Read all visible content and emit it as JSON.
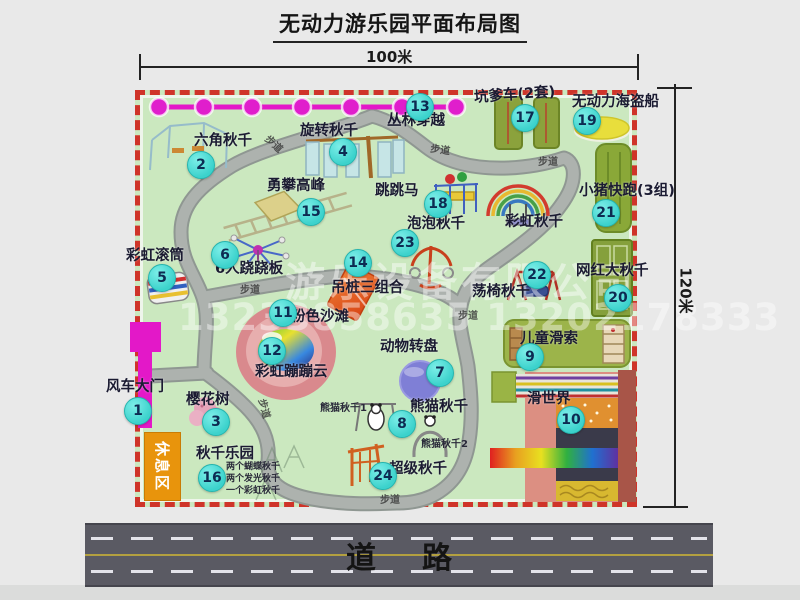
{
  "title": "无动力游乐园平面布局图",
  "dimensions": {
    "width_label": "100米",
    "height_label": "120米"
  },
  "road": {
    "label": "道路"
  },
  "rest_area": {
    "label": "休息区"
  },
  "watermark": {
    "company": "游乐设备有限公司",
    "phone": "13233858635 13202178333"
  },
  "colors": {
    "park_green": "#cbe8bf",
    "border_red": "#cf3429",
    "path_gray": "#a9afab",
    "marker_fill": "#3cd2cc",
    "marker_text": "#0d2b52",
    "zipline_magenta": "#e318c8",
    "road_gray": "#5a5a63",
    "rest_orange": "#e8940c",
    "pink_beach": "#d9898d"
  },
  "attractions": [
    {
      "num": 1,
      "key": "windmill-gate",
      "name": "风车大门",
      "mx": 137,
      "my": 410,
      "lx": 106,
      "ly": 380
    },
    {
      "num": 2,
      "key": "hexagon-swing",
      "name": "六角秋千",
      "mx": 200,
      "my": 164,
      "lx": 194,
      "ly": 134
    },
    {
      "num": 3,
      "key": "cherry-tree",
      "name": "樱花树",
      "mx": 215,
      "my": 421,
      "lx": 186,
      "ly": 393
    },
    {
      "num": 4,
      "key": "rotating-swing",
      "name": "旋转秋千",
      "mx": 342,
      "my": 151,
      "lx": 300,
      "ly": 124
    },
    {
      "num": 5,
      "key": "rainbow-roller",
      "name": "彩虹滚筒",
      "mx": 161,
      "my": 277,
      "lx": 126,
      "ly": 249
    },
    {
      "num": 6,
      "key": "six-seesaw",
      "name": "6人跷跷板",
      "mx": 224,
      "my": 254,
      "lx": 215,
      "ly": 262
    },
    {
      "num": 7,
      "key": "animal-carousel",
      "name": "动物转盘",
      "mx": 439,
      "my": 372,
      "lx": 380,
      "ly": 340
    },
    {
      "num": 8,
      "key": "panda-swing",
      "name": "熊猫秋千",
      "mx": 401,
      "my": 423,
      "lx": 410,
      "ly": 400
    },
    {
      "num": 9,
      "key": "kids-zipline",
      "name": "儿童滑索",
      "mx": 529,
      "my": 356,
      "lx": 520,
      "ly": 332
    },
    {
      "num": 10,
      "key": "slide-world",
      "name": "滑世界",
      "mx": 570,
      "my": 419,
      "lx": 527,
      "ly": 392
    },
    {
      "num": 11,
      "key": "pink-beach",
      "name": "粉色沙滩",
      "mx": 282,
      "my": 312,
      "lx": 291,
      "ly": 310
    },
    {
      "num": 12,
      "key": "rainbow-cloud",
      "name": "彩虹蹦蹦云",
      "mx": 271,
      "my": 350,
      "lx": 255,
      "ly": 365
    },
    {
      "num": 13,
      "key": "jungle-crossing",
      "name": "丛林穿越",
      "mx": 419,
      "my": 106,
      "lx": 387,
      "ly": 114
    },
    {
      "num": 14,
      "key": "hanging-post-combo",
      "name": "吊桩三组合",
      "mx": 357,
      "my": 262,
      "lx": 331,
      "ly": 281
    },
    {
      "num": 15,
      "key": "peak-climbing",
      "name": "勇攀高峰",
      "mx": 310,
      "my": 211,
      "lx": 267,
      "ly": 179
    },
    {
      "num": 16,
      "key": "swing-park",
      "name": "秋千乐园",
      "mx": 211,
      "my": 477,
      "lx": 196,
      "ly": 447
    },
    {
      "num": 17,
      "key": "pit-cart",
      "name": "坑爹车(2套)",
      "mx": 524,
      "my": 117,
      "lx": 474,
      "ly": 88,
      "lr": -4
    },
    {
      "num": 18,
      "key": "jumping-horse",
      "name": "跳跳马",
      "mx": 437,
      "my": 203,
      "lx": 375,
      "ly": 184
    },
    {
      "num": 19,
      "key": "pirate-ship",
      "name": "无动力海盗船",
      "mx": 586,
      "my": 120,
      "lx": 572,
      "ly": 95
    },
    {
      "num": 20,
      "key": "big-net-swing",
      "name": "网红大秋千",
      "mx": 617,
      "my": 297,
      "lx": 576,
      "ly": 264
    },
    {
      "num": 21,
      "key": "piggy-run",
      "name": "小猪快跑(3组)",
      "mx": 605,
      "my": 212,
      "lx": 579,
      "ly": 184
    },
    {
      "num": 22,
      "key": "chair-swing",
      "name": "荡椅秋千",
      "mx": 536,
      "my": 274,
      "lx": 472,
      "ly": 285
    },
    {
      "num": 23,
      "key": "bubble-swing",
      "name": "泡泡秋千",
      "mx": 404,
      "my": 242,
      "lx": 407,
      "ly": 217
    },
    {
      "num": 24,
      "key": "super-swing",
      "name": "超级秋千",
      "mx": 382,
      "my": 475,
      "lx": 389,
      "ly": 462
    },
    {
      "num": null,
      "key": "rainbow-swing",
      "name": "彩虹秋千",
      "lx": 505,
      "ly": 215
    }
  ],
  "notes": [
    {
      "key": "panda-swing-1",
      "text": "熊猫秋千1",
      "x": 320,
      "y": 404,
      "size": 10
    },
    {
      "key": "panda-swing-2",
      "text": "熊猫秋千2",
      "x": 421,
      "y": 440,
      "size": 10
    },
    {
      "key": "swing-park-note-1",
      "text": "两个蝴蝶秋千",
      "x": 226,
      "y": 463,
      "size": 9
    },
    {
      "key": "swing-park-note-2",
      "text": "两个发光秋千",
      "x": 226,
      "y": 475,
      "size": 9
    },
    {
      "key": "swing-park-note-3",
      "text": "一个彩虹秋千",
      "x": 226,
      "y": 487,
      "size": 9
    }
  ],
  "path_labels": [
    {
      "text": "步道",
      "x": 263,
      "y": 140,
      "rot": 42
    },
    {
      "text": "步道",
      "x": 430,
      "y": 146,
      "rot": 8
    },
    {
      "text": "步道",
      "x": 538,
      "y": 158,
      "rot": 0
    },
    {
      "text": "步道",
      "x": 240,
      "y": 286,
      "rot": 0
    },
    {
      "text": "步道",
      "x": 253,
      "y": 404,
      "rot": 75
    },
    {
      "text": "步道",
      "x": 458,
      "y": 312,
      "rot": 0
    },
    {
      "text": "步道",
      "x": 380,
      "y": 496,
      "rot": 0
    }
  ]
}
